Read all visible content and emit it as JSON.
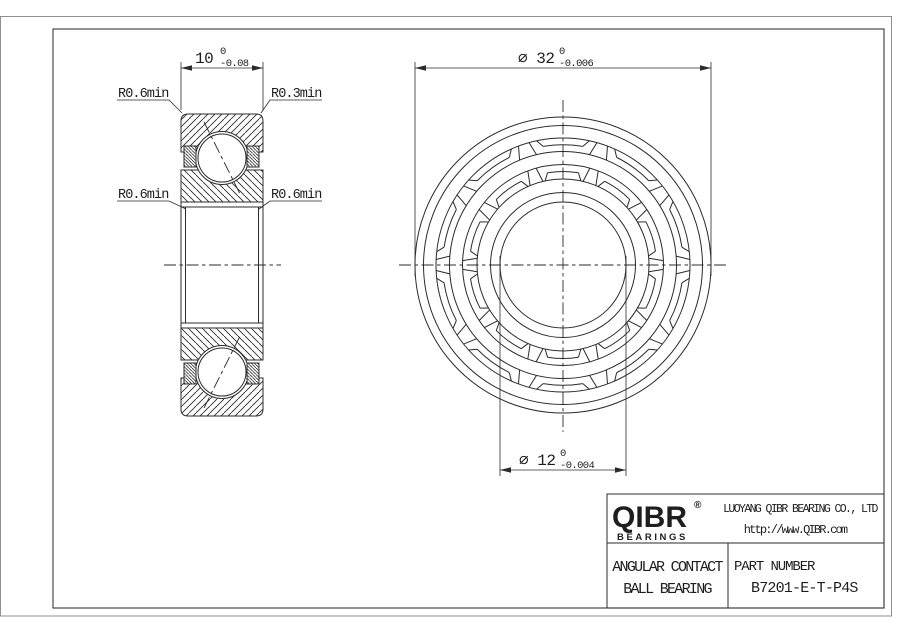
{
  "drawing": {
    "dim_width": {
      "value": "10",
      "tol_top": "0",
      "tol_bottom": "-0.08"
    },
    "dim_od": {
      "value": "⌀ 32",
      "tol_top": "0",
      "tol_bottom": "-0.006"
    },
    "dim_bore": {
      "value": "⌀ 12",
      "tol_top": "0",
      "tol_bottom": "-0.004"
    },
    "radius_labels": {
      "top_left": "R0.6min",
      "top_right": "R0.3min",
      "mid_left": "R0.6min",
      "mid_right": "R0.6min"
    }
  },
  "title_block": {
    "logo_text": "QIBR",
    "logo_reg": "®",
    "logo_sub": "BEARINGS",
    "company": "LUOYANG QIBR BEARING CO., LTD",
    "website": "http://www.QIBR.com",
    "product_line1": "ANGULAR CONTACT",
    "product_line2": "BALL BEARING",
    "part_label": "PART NUMBER",
    "part_number": "B7201-E-T-P4S"
  },
  "colors": {
    "line": "#2b2b2b",
    "background": "#ffffff"
  }
}
